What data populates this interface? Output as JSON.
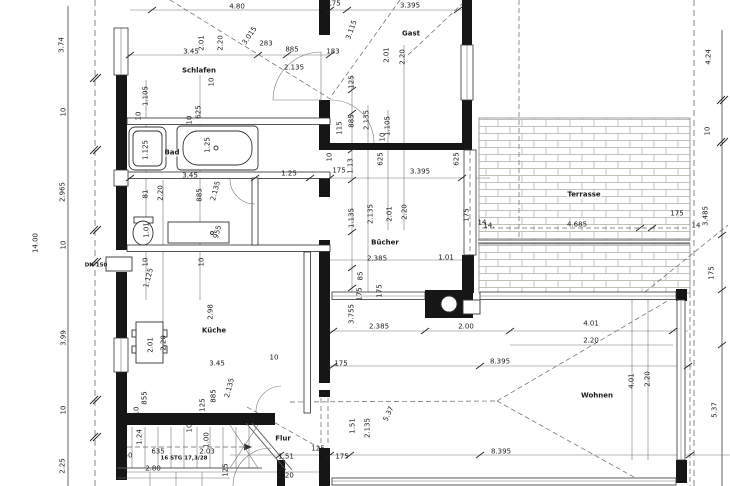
{
  "drawing": {
    "kind": "architectural floor plan",
    "stair_note": "16 STG 17,3/28",
    "duct_note": "DN 150"
  },
  "rooms": [
    "Schlafen",
    "Bad",
    "Gast",
    "Bücher",
    "Küche",
    "Flur",
    "Wohnen",
    "Terrasse"
  ],
  "colors": {
    "wall": "#161616",
    "line": "#555555",
    "paper": "#ffffff",
    "brick": "#b0aba4"
  },
  "labels": [
    {
      "text": "4.80",
      "x": 237,
      "y": 7,
      "rot": 0,
      "kind": "dim"
    },
    {
      "text": "175",
      "x": 334,
      "y": 4,
      "rot": 0,
      "kind": "dim"
    },
    {
      "text": "3.395",
      "x": 410,
      "y": 6,
      "rot": 0,
      "kind": "dim"
    },
    {
      "text": "3.74",
      "x": 62,
      "y": 45,
      "rot": -90,
      "kind": "dim"
    },
    {
      "text": "10",
      "x": 64,
      "y": 112,
      "rot": -90,
      "kind": "dim"
    },
    {
      "text": "2.965",
      "x": 63,
      "y": 192,
      "rot": -90,
      "kind": "dim"
    },
    {
      "text": "10",
      "x": 64,
      "y": 245,
      "rot": -90,
      "kind": "dim"
    },
    {
      "text": "3.99",
      "x": 64,
      "y": 338,
      "rot": -90,
      "kind": "dim"
    },
    {
      "text": "10",
      "x": 64,
      "y": 410,
      "rot": -90,
      "kind": "dim"
    },
    {
      "text": "2.25",
      "x": 63,
      "y": 466,
      "rot": -90,
      "kind": "dim"
    },
    {
      "text": "14.00",
      "x": 36,
      "y": 243,
      "rot": -90,
      "kind": "dim"
    },
    {
      "text": "2.01",
      "x": 202,
      "y": 43,
      "rot": -90,
      "kind": "dim"
    },
    {
      "text": "2.20",
      "x": 221,
      "y": 43,
      "rot": -90,
      "kind": "dim"
    },
    {
      "text": "3.015",
      "x": 250,
      "y": 36,
      "rot": -55,
      "kind": "dim"
    },
    {
      "text": "3.45",
      "x": 191,
      "y": 52,
      "rot": 0,
      "kind": "dim"
    },
    {
      "text": "Schlafen",
      "x": 199,
      "y": 71,
      "rot": 0,
      "kind": "room"
    },
    {
      "text": "10",
      "x": 212,
      "y": 82,
      "rot": -90,
      "kind": "dim"
    },
    {
      "text": "1.105",
      "x": 146,
      "y": 96,
      "rot": -90,
      "kind": "dim"
    },
    {
      "text": "10",
      "x": 139,
      "y": 116,
      "rot": -90,
      "kind": "dim"
    },
    {
      "text": "625",
      "x": 199,
      "y": 112,
      "rot": -90,
      "kind": "dim"
    },
    {
      "text": "10",
      "x": 190,
      "y": 120,
      "rot": -90,
      "kind": "dim"
    },
    {
      "text": "283",
      "x": 266,
      "y": 44,
      "rot": 0,
      "kind": "dim"
    },
    {
      "text": "885",
      "x": 292,
      "y": 50,
      "rot": 0,
      "kind": "dim"
    },
    {
      "text": "2.135",
      "x": 294,
      "y": 68,
      "rot": 0,
      "kind": "dim"
    },
    {
      "text": "183",
      "x": 333,
      "y": 52,
      "rot": 0,
      "kind": "dim"
    },
    {
      "text": "3.115",
      "x": 352,
      "y": 30,
      "rot": -70,
      "kind": "dim"
    },
    {
      "text": "125",
      "x": 352,
      "y": 82,
      "rot": -90,
      "kind": "dim"
    },
    {
      "text": "885",
      "x": 352,
      "y": 121,
      "rot": -90,
      "kind": "dim"
    },
    {
      "text": "2.135",
      "x": 367,
      "y": 120,
      "rot": -90,
      "kind": "dim"
    },
    {
      "text": "1.105",
      "x": 388,
      "y": 126,
      "rot": -90,
      "kind": "dim"
    },
    {
      "text": "115",
      "x": 340,
      "y": 128,
      "rot": -90,
      "kind": "dim"
    },
    {
      "text": "10",
      "x": 383,
      "y": 137,
      "rot": -90,
      "kind": "dim"
    },
    {
      "text": "Gast",
      "x": 411,
      "y": 34,
      "rot": 0,
      "kind": "room"
    },
    {
      "text": "2.01",
      "x": 387,
      "y": 55,
      "rot": -90,
      "kind": "dim"
    },
    {
      "text": "2.20",
      "x": 403,
      "y": 57,
      "rot": -90,
      "kind": "dim"
    },
    {
      "text": "1.125",
      "x": 146,
      "y": 150,
      "rot": -90,
      "kind": "dim"
    },
    {
      "text": "Bad",
      "x": 172,
      "y": 153,
      "rot": 0,
      "kind": "room"
    },
    {
      "text": "1.25",
      "x": 208,
      "y": 145,
      "rot": -90,
      "kind": "dim"
    },
    {
      "text": "3.45",
      "x": 190,
      "y": 176,
      "rot": 0,
      "kind": "dim"
    },
    {
      "text": "1.25",
      "x": 289,
      "y": 174,
      "rot": 0,
      "kind": "dim"
    },
    {
      "text": "10",
      "x": 330,
      "y": 157,
      "rot": -90,
      "kind": "dim"
    },
    {
      "text": "175",
      "x": 339,
      "y": 171,
      "rot": 0,
      "kind": "dim"
    },
    {
      "text": "1.13",
      "x": 351,
      "y": 166,
      "rot": -90,
      "kind": "dim"
    },
    {
      "text": "625",
      "x": 381,
      "y": 159,
      "rot": -90,
      "kind": "dim"
    },
    {
      "text": "625",
      "x": 457,
      "y": 159,
      "rot": -90,
      "kind": "dim"
    },
    {
      "text": "3.395",
      "x": 420,
      "y": 172,
      "rot": 0,
      "kind": "dim"
    },
    {
      "text": "81",
      "x": 146,
      "y": 194,
      "rot": -90,
      "kind": "dim"
    },
    {
      "text": "2.20",
      "x": 161,
      "y": 193,
      "rot": -90,
      "kind": "dim"
    },
    {
      "text": "885",
      "x": 200,
      "y": 195,
      "rot": -90,
      "kind": "dim"
    },
    {
      "text": "2.135",
      "x": 216,
      "y": 191,
      "rot": -75,
      "kind": "dim"
    },
    {
      "text": "1.01",
      "x": 147,
      "y": 230,
      "rot": -90,
      "kind": "dim"
    },
    {
      "text": "955",
      "x": 218,
      "y": 232,
      "rot": -75,
      "kind": "dim"
    },
    {
      "text": "10",
      "x": 146,
      "y": 262,
      "rot": -90,
      "kind": "dim"
    },
    {
      "text": "10",
      "x": 202,
      "y": 262,
      "rot": -90,
      "kind": "dim"
    },
    {
      "text": "DN 150",
      "x": 96,
      "y": 266,
      "rot": 0,
      "kind": "note"
    },
    {
      "text": "1.125",
      "x": 149,
      "y": 278,
      "rot": -75,
      "kind": "dim"
    },
    {
      "text": "1.135",
      "x": 352,
      "y": 218,
      "rot": -90,
      "kind": "dim"
    },
    {
      "text": "2.135",
      "x": 371,
      "y": 214,
      "rot": -90,
      "kind": "dim"
    },
    {
      "text": "2.01",
      "x": 390,
      "y": 214,
      "rot": -90,
      "kind": "dim"
    },
    {
      "text": "2.20",
      "x": 405,
      "y": 212,
      "rot": -90,
      "kind": "dim"
    },
    {
      "text": "Bücher",
      "x": 385,
      "y": 243,
      "rot": 0,
      "kind": "room"
    },
    {
      "text": "2.385",
      "x": 377,
      "y": 259,
      "rot": 0,
      "kind": "dim"
    },
    {
      "text": "1.01",
      "x": 446,
      "y": 258,
      "rot": 0,
      "kind": "dim"
    },
    {
      "text": "85",
      "x": 361,
      "y": 276,
      "rot": -90,
      "kind": "dim"
    },
    {
      "text": "175",
      "x": 360,
      "y": 294,
      "rot": -90,
      "kind": "dim"
    },
    {
      "text": "175",
      "x": 380,
      "y": 291,
      "rot": -90,
      "kind": "dim"
    },
    {
      "text": "175",
      "x": 467,
      "y": 215,
      "rot": -90,
      "kind": "dim"
    },
    {
      "text": "14",
      "x": 482,
      "y": 223,
      "rot": 0,
      "kind": "dim"
    },
    {
      "text": "Terrasse",
      "x": 584,
      "y": 195,
      "rot": 0,
      "kind": "room"
    },
    {
      "text": "14.",
      "x": 489,
      "y": 226,
      "rot": 0,
      "kind": "dim"
    },
    {
      "text": "4.685",
      "x": 577,
      "y": 225,
      "rot": 0,
      "kind": "dim"
    },
    {
      "text": "175",
      "x": 677,
      "y": 214,
      "rot": 0,
      "kind": "dim"
    },
    {
      "text": "3.485",
      "x": 706,
      "y": 216,
      "rot": -90,
      "kind": "dim"
    },
    {
      "text": "14",
      "x": 696,
      "y": 226,
      "rot": 0,
      "kind": "dim"
    },
    {
      "text": "175",
      "x": 712,
      "y": 273,
      "rot": -90,
      "kind": "dim"
    },
    {
      "text": "4.24",
      "x": 709,
      "y": 57,
      "rot": -90,
      "kind": "dim"
    },
    {
      "text": "10",
      "x": 708,
      "y": 131,
      "rot": -90,
      "kind": "dim"
    },
    {
      "text": "2.98",
      "x": 211,
      "y": 312,
      "rot": -90,
      "kind": "dim"
    },
    {
      "text": "Küche",
      "x": 214,
      "y": 331,
      "rot": 0,
      "kind": "room"
    },
    {
      "text": "2.01",
      "x": 151,
      "y": 345,
      "rot": -90,
      "kind": "dim"
    },
    {
      "text": "2.20",
      "x": 164,
      "y": 343,
      "rot": -90,
      "kind": "dim"
    },
    {
      "text": "3.45",
      "x": 217,
      "y": 364,
      "rot": 0,
      "kind": "dim"
    },
    {
      "text": "10",
      "x": 274,
      "y": 358,
      "rot": 0,
      "kind": "dim"
    },
    {
      "text": "3.755",
      "x": 352,
      "y": 314,
      "rot": -90,
      "kind": "dim"
    },
    {
      "text": "2.385",
      "x": 379,
      "y": 327,
      "rot": 0,
      "kind": "dim"
    },
    {
      "text": "2.00",
      "x": 466,
      "y": 327,
      "rot": 0,
      "kind": "dim"
    },
    {
      "text": "175",
      "x": 341,
      "y": 364,
      "rot": 0,
      "kind": "dim"
    },
    {
      "text": "8.395",
      "x": 500,
      "y": 362,
      "rot": 0,
      "kind": "dim"
    },
    {
      "text": "4.01",
      "x": 591,
      "y": 324,
      "rot": 0,
      "kind": "dim"
    },
    {
      "text": "2.20",
      "x": 591,
      "y": 341,
      "rot": 0,
      "kind": "dim"
    },
    {
      "text": "Wohnen",
      "x": 597,
      "y": 396,
      "rot": 0,
      "kind": "room"
    },
    {
      "text": "4.01",
      "x": 632,
      "y": 381,
      "rot": -90,
      "kind": "dim"
    },
    {
      "text": "2.20",
      "x": 648,
      "y": 379,
      "rot": -90,
      "kind": "dim"
    },
    {
      "text": "8.395",
      "x": 501,
      "y": 452,
      "rot": 0,
      "kind": "dim"
    },
    {
      "text": "5.37",
      "x": 715,
      "y": 410,
      "rot": -90,
      "kind": "dim"
    },
    {
      "text": "855",
      "x": 145,
      "y": 398,
      "rot": -90,
      "kind": "dim"
    },
    {
      "text": "10",
      "x": 137,
      "y": 411,
      "rot": -90,
      "kind": "dim"
    },
    {
      "text": "125",
      "x": 203,
      "y": 405,
      "rot": -90,
      "kind": "dim"
    },
    {
      "text": "885",
      "x": 214,
      "y": 396,
      "rot": -90,
      "kind": "dim"
    },
    {
      "text": "2.135",
      "x": 230,
      "y": 388,
      "rot": -75,
      "kind": "dim"
    },
    {
      "text": "1.24",
      "x": 140,
      "y": 437,
      "rot": -90,
      "kind": "dim"
    },
    {
      "text": "10",
      "x": 190,
      "y": 428,
      "rot": -90,
      "kind": "dim"
    },
    {
      "text": "1.00",
      "x": 207,
      "y": 440,
      "rot": -90,
      "kind": "dim"
    },
    {
      "text": "50",
      "x": 128,
      "y": 456,
      "rot": 0,
      "kind": "dim"
    },
    {
      "text": "635",
      "x": 158,
      "y": 452,
      "rot": 0,
      "kind": "dim"
    },
    {
      "text": "16 STG 17,3/28",
      "x": 184,
      "y": 459,
      "rot": 0,
      "kind": "note"
    },
    {
      "text": "2.03",
      "x": 207,
      "y": 452,
      "rot": 0,
      "kind": "dim"
    },
    {
      "text": "2.80",
      "x": 153,
      "y": 469,
      "rot": 0,
      "kind": "dim"
    },
    {
      "text": "125",
      "x": 226,
      "y": 470,
      "rot": -90,
      "kind": "dim"
    },
    {
      "text": "Flur",
      "x": 283,
      "y": 439,
      "rot": 0,
      "kind": "room"
    },
    {
      "text": "1.51",
      "x": 286,
      "y": 457,
      "rot": 0,
      "kind": "dim"
    },
    {
      "text": "2.20",
      "x": 286,
      "y": 476,
      "rot": 0,
      "kind": "dim"
    },
    {
      "text": "125",
      "x": 318,
      "y": 449,
      "rot": 0,
      "kind": "dim"
    },
    {
      "text": "175",
      "x": 342,
      "y": 457,
      "rot": 0,
      "kind": "dim"
    },
    {
      "text": "1.51",
      "x": 353,
      "y": 426,
      "rot": -90,
      "kind": "dim"
    },
    {
      "text": "2.135",
      "x": 368,
      "y": 428,
      "rot": -90,
      "kind": "dim"
    },
    {
      "text": "5.37",
      "x": 389,
      "y": 414,
      "rot": -65,
      "kind": "dim"
    }
  ]
}
